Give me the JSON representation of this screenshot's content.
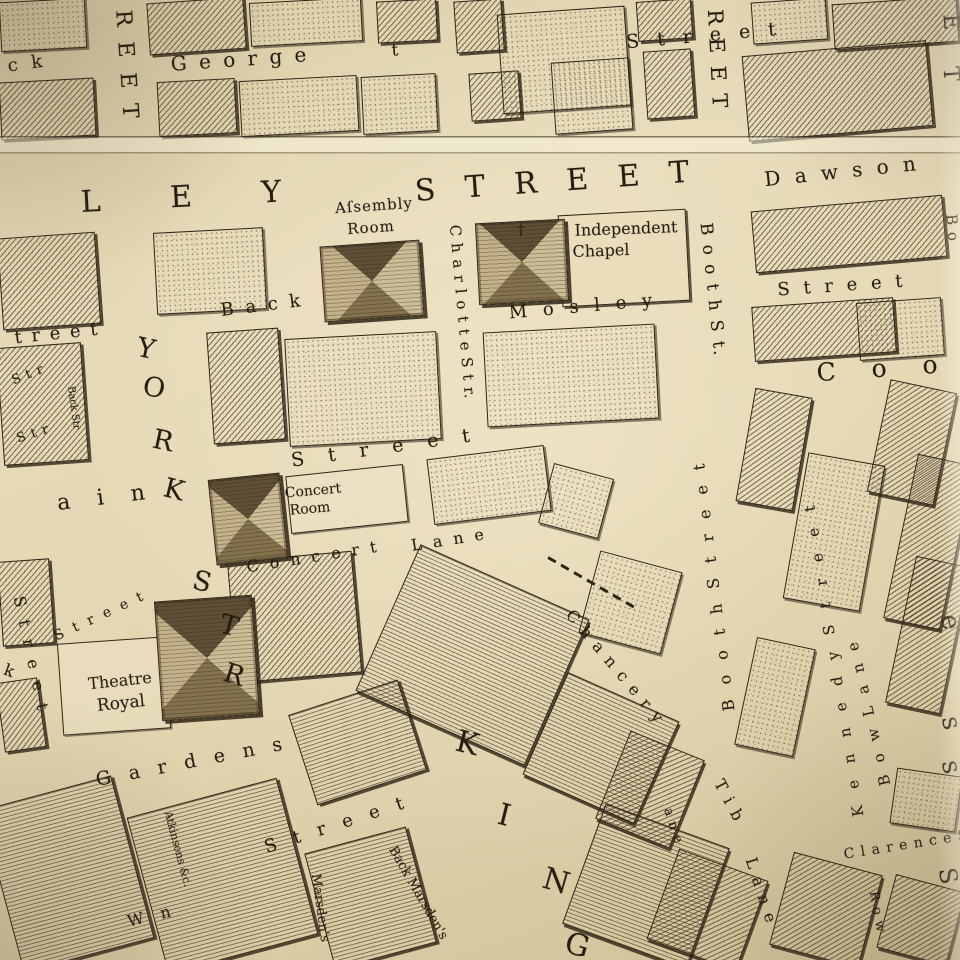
{
  "map": {
    "title": "Antique engraved town-plan (Mosley Street / King Street district)",
    "paper_color": "#e3d6b2",
    "ink_color": "#2e2415",
    "crease_y": 138,
    "labels": [
      {
        "name": "back-fragment",
        "text": "c k",
        "x": 27,
        "y": 64,
        "rot": -8,
        "size": 18,
        "ls": 4
      },
      {
        "name": "street-vertical-left",
        "text": "R E E T",
        "x": 126,
        "y": 66,
        "rot": 86,
        "size": 22,
        "ls": 4
      },
      {
        "name": "george-street",
        "text": "G e o r g e",
        "x": 240,
        "y": 59,
        "rot": -4,
        "size": 20,
        "ls": 3
      },
      {
        "name": "george-street-t",
        "text": "t",
        "x": 395,
        "y": 51,
        "rot": -4,
        "size": 17,
        "ls": 0
      },
      {
        "name": "street-top-right",
        "text": "S t r e e t",
        "x": 704,
        "y": 36,
        "rot": -5,
        "size": 19,
        "ls": 6
      },
      {
        "name": "street-vertical-top-2",
        "text": "R E E T",
        "x": 717,
        "y": 60,
        "rot": 87,
        "size": 21,
        "ls": 3
      },
      {
        "name": "mosley-ley",
        "text": "L E Y",
        "x": 196,
        "y": 197,
        "rot": -3,
        "size": 30,
        "ls": 30
      },
      {
        "name": "mosley-street-big",
        "text": "S T R E E T",
        "x": 557,
        "y": 182,
        "rot": -4,
        "size": 30,
        "ls": 10
      },
      {
        "name": "dawson-street",
        "text": "D a w s o n",
        "x": 842,
        "y": 171,
        "rot": -6,
        "size": 20,
        "ls": 4
      },
      {
        "name": "assembly-room-line1",
        "text": "Aſsembly",
        "x": 374,
        "y": 206,
        "rot": -4,
        "size": 15,
        "ls": 1
      },
      {
        "name": "assembly-room-line2",
        "text": "Room",
        "x": 371,
        "y": 228,
        "rot": -4,
        "size": 15,
        "ls": 1
      },
      {
        "name": "booth-st",
        "text": "B o o t h   S t.",
        "x": 712,
        "y": 290,
        "rot": 84,
        "size": 17,
        "ls": 2
      },
      {
        "name": "charlotte-str",
        "text": "C h a r l o t t e   S t r.",
        "x": 462,
        "y": 312,
        "rot": 85,
        "size": 15,
        "ls": 1
      },
      {
        "name": "independent-chapel-line1",
        "text": "Independent",
        "x": 626,
        "y": 229,
        "rot": -2,
        "size": 16,
        "ls": 0
      },
      {
        "name": "independent-chapel-line2",
        "text": "Chapel",
        "x": 601,
        "y": 251,
        "rot": -2,
        "size": 16,
        "ls": 0
      },
      {
        "name": "chapel-cross",
        "text": "†",
        "x": 521,
        "y": 230,
        "rot": 0,
        "size": 15,
        "ls": 0
      },
      {
        "name": "back-mosley-back",
        "text": "B a c k",
        "x": 262,
        "y": 306,
        "rot": -7,
        "size": 18,
        "ls": 3
      },
      {
        "name": "back-mosley-mosley",
        "text": "M o s l e y",
        "x": 583,
        "y": 307,
        "rot": -5,
        "size": 18,
        "ls": 5
      },
      {
        "name": "street-right-row",
        "text": "S t r e e t",
        "x": 842,
        "y": 286,
        "rot": -4,
        "size": 18,
        "ls": 4
      },
      {
        "name": "cooper-street-coo",
        "text": "C o o",
        "x": 884,
        "y": 368,
        "rot": -4,
        "size": 25,
        "ls": 14
      },
      {
        "name": "street-left-treet",
        "text": "t r e e t",
        "x": 57,
        "y": 334,
        "rot": -6,
        "size": 18,
        "ls": 2
      },
      {
        "name": "str-stub-1",
        "text": "S t r",
        "x": 28,
        "y": 375,
        "rot": -22,
        "size": 13,
        "ls": 1
      },
      {
        "name": "back-str-stub",
        "text": "Back Str",
        "x": 73,
        "y": 408,
        "rot": 82,
        "size": 10,
        "ls": 0
      },
      {
        "name": "str-stub-2",
        "text": "S t r",
        "x": 33,
        "y": 434,
        "rot": -18,
        "size": 13,
        "ls": 1
      },
      {
        "name": "york-letter-y",
        "text": "Y",
        "x": 146,
        "y": 349,
        "rot": 12,
        "size": 27,
        "ls": 0
      },
      {
        "name": "york-letter-o",
        "text": "O",
        "x": 154,
        "y": 388,
        "rot": 10,
        "size": 27,
        "ls": 0
      },
      {
        "name": "york-letter-r",
        "text": "R",
        "x": 163,
        "y": 441,
        "rot": 12,
        "size": 27,
        "ls": 0
      },
      {
        "name": "york-letter-k",
        "text": "K",
        "x": 174,
        "y": 490,
        "rot": 14,
        "size": 27,
        "ls": 0
      },
      {
        "name": "fountain-ain",
        "text": "a i n",
        "x": 106,
        "y": 498,
        "rot": -7,
        "size": 22,
        "ls": 10
      },
      {
        "name": "street-mid",
        "text": "S t r e e t",
        "x": 385,
        "y": 448,
        "rot": -8,
        "size": 19,
        "ls": 9
      },
      {
        "name": "concert-room-line1",
        "text": "Concert",
        "x": 313,
        "y": 491,
        "rot": -5,
        "size": 14,
        "ls": 0
      },
      {
        "name": "concert-room-line2",
        "text": "Room",
        "x": 310,
        "y": 509,
        "rot": -5,
        "size": 14,
        "ls": 0
      },
      {
        "name": "concert-lane-concert",
        "text": "C o n c e r t",
        "x": 313,
        "y": 557,
        "rot": -9,
        "size": 16,
        "ls": 3
      },
      {
        "name": "concert-lane-lane",
        "text": "L a n e",
        "x": 449,
        "y": 540,
        "rot": -9,
        "size": 16,
        "ls": 3
      },
      {
        "name": "chancery-lane-chancery",
        "text": "C h a n c e r y",
        "x": 615,
        "y": 667,
        "rot": 50,
        "size": 16,
        "ls": 2
      },
      {
        "name": "chancery-lane-ane",
        "text": "a n e",
        "x": 673,
        "y": 826,
        "rot": 72,
        "size": 13,
        "ls": 1
      },
      {
        "name": "booth-street-lower",
        "text": "B o o t h   S t r e e t",
        "x": 714,
        "y": 585,
        "rot": -97,
        "size": 16,
        "ls": 5
      },
      {
        "name": "kennedy-street",
        "text": "K e n n e d y   S t r e e t",
        "x": 834,
        "y": 658,
        "rot": -99,
        "size": 15,
        "ls": 6
      },
      {
        "name": "bow-lane",
        "text": "B o w   L a n e",
        "x": 869,
        "y": 712,
        "rot": -103,
        "size": 15,
        "ls": 4
      },
      {
        "name": "tib-lane-tib",
        "text": "T i b",
        "x": 729,
        "y": 801,
        "rot": 62,
        "size": 16,
        "ls": 2
      },
      {
        "name": "tib-lane-lane",
        "text": "L a n e",
        "x": 761,
        "y": 891,
        "rot": 72,
        "size": 16,
        "ls": 2
      },
      {
        "name": "clarence-street",
        "text": "C l a r e n c e   S",
        "x": 906,
        "y": 845,
        "rot": -9,
        "size": 14,
        "ls": 1
      },
      {
        "name": "row-label",
        "text": "R o w",
        "x": 877,
        "y": 912,
        "rot": 80,
        "size": 13,
        "ls": 1
      },
      {
        "name": "right-edge-letter-s3",
        "text": "S",
        "x": 948,
        "y": 876,
        "rot": 80,
        "size": 24,
        "ls": 0
      },
      {
        "name": "princess-letter-e",
        "text": "e",
        "x": 950,
        "y": 622,
        "rot": 78,
        "size": 26,
        "ls": 0
      },
      {
        "name": "princess-letter-s1",
        "text": "s",
        "x": 951,
        "y": 723,
        "rot": 78,
        "size": 26,
        "ls": 0
      },
      {
        "name": "princess-letter-s2",
        "text": "s",
        "x": 951,
        "y": 767,
        "rot": 78,
        "size": 26,
        "ls": 0
      },
      {
        "name": "right-edge-letter-e",
        "text": "E",
        "x": 950,
        "y": 22,
        "rot": 85,
        "size": 22,
        "ls": 0
      },
      {
        "name": "right-edge-letter-t",
        "text": "T",
        "x": 950,
        "y": 74,
        "rot": 85,
        "size": 22,
        "ls": 0
      },
      {
        "name": "bond-street-bo",
        "text": "B o",
        "x": 952,
        "y": 228,
        "rot": 85,
        "size": 15,
        "ls": 1
      },
      {
        "name": "king-letter-k",
        "text": "K",
        "x": 467,
        "y": 744,
        "rot": 14,
        "size": 30,
        "ls": 0
      },
      {
        "name": "king-letter-i",
        "text": "I",
        "x": 504,
        "y": 816,
        "rot": 14,
        "size": 30,
        "ls": 0
      },
      {
        "name": "king-letter-n",
        "text": "N",
        "x": 556,
        "y": 882,
        "rot": 16,
        "size": 30,
        "ls": 0
      },
      {
        "name": "king-letter-g",
        "text": "G",
        "x": 577,
        "y": 946,
        "rot": 16,
        "size": 30,
        "ls": 0
      },
      {
        "name": "street-southwest",
        "text": "S t r e e t",
        "x": 337,
        "y": 825,
        "rot": -18,
        "size": 18,
        "ls": 6
      },
      {
        "name": "w-n-fragment",
        "text": "W n",
        "x": 152,
        "y": 916,
        "rot": -14,
        "size": 16,
        "ls": 6
      },
      {
        "name": "marsdens-street",
        "text": "Marsden's",
        "x": 320,
        "y": 908,
        "rot": 82,
        "size": 13,
        "ls": 0
      },
      {
        "name": "back-marsdens",
        "text": "Back Marsden's",
        "x": 418,
        "y": 893,
        "rot": 60,
        "size": 13,
        "ls": 0
      },
      {
        "name": "atkinsons-court",
        "text": "Atkinsons &c.",
        "x": 178,
        "y": 849,
        "rot": 75,
        "size": 11,
        "ls": 0
      },
      {
        "name": "k-fragment",
        "text": "k",
        "x": 9,
        "y": 671,
        "rot": 20,
        "size": 16,
        "ls": 0
      },
      {
        "name": "street-left-vertical",
        "text": "S t r e e t",
        "x": 31,
        "y": 655,
        "rot": 78,
        "size": 16,
        "ls": 4
      },
      {
        "name": "street-nw-theatre",
        "text": "S t r e e t",
        "x": 100,
        "y": 616,
        "rot": -25,
        "size": 14,
        "ls": 3
      },
      {
        "name": "theatre-royal-line1",
        "text": "Theatre",
        "x": 120,
        "y": 681,
        "rot": -6,
        "size": 16,
        "ls": 0
      },
      {
        "name": "theatre-royal-line2",
        "text": "Royal",
        "x": 121,
        "y": 704,
        "rot": -6,
        "size": 17,
        "ls": 0
      },
      {
        "name": "spring-gardens",
        "text": "G a r d e n s",
        "x": 192,
        "y": 762,
        "rot": -11,
        "size": 19,
        "ls": 6
      },
      {
        "name": "york-street-letter-s",
        "text": "S",
        "x": 202,
        "y": 582,
        "rot": 14,
        "size": 27,
        "ls": 0
      },
      {
        "name": "york-street-letter-t",
        "text": "T",
        "x": 229,
        "y": 626,
        "rot": 16,
        "size": 27,
        "ls": 0
      },
      {
        "name": "york-street-letter-r",
        "text": "R",
        "x": 234,
        "y": 675,
        "rot": 18,
        "size": 27,
        "ls": 0
      }
    ],
    "buildings": [
      {
        "name": "assembly-room-building",
        "x": 322,
        "y": 243,
        "w": 100,
        "h": 76,
        "rot": -4
      },
      {
        "name": "independent-chapel-building",
        "x": 477,
        "y": 221,
        "w": 90,
        "h": 82,
        "rot": -3
      },
      {
        "name": "concert-room-building",
        "x": 212,
        "y": 476,
        "w": 72,
        "h": 86,
        "rot": -6
      },
      {
        "name": "theatre-royal-building",
        "x": 158,
        "y": 598,
        "w": 98,
        "h": 120,
        "rot": -4
      }
    ],
    "blocks": [
      {
        "x": 0,
        "y": 0,
        "w": 86,
        "h": 50,
        "t": "st",
        "r": -3
      },
      {
        "x": 148,
        "y": 0,
        "w": 97,
        "h": 52,
        "t": "h",
        "r": -4
      },
      {
        "x": 250,
        "y": 0,
        "w": 112,
        "h": 44,
        "t": "st",
        "r": -3
      },
      {
        "x": 377,
        "y": 0,
        "w": 60,
        "h": 42,
        "t": "h",
        "r": -3
      },
      {
        "x": 455,
        "y": 0,
        "w": 48,
        "h": 52,
        "t": "h",
        "r": -4
      },
      {
        "x": 500,
        "y": 10,
        "w": 128,
        "h": 100,
        "t": "st",
        "r": -4
      },
      {
        "x": 637,
        "y": 0,
        "w": 55,
        "h": 40,
        "t": "h",
        "r": -4
      },
      {
        "x": 752,
        "y": 0,
        "w": 75,
        "h": 42,
        "t": "st",
        "r": -4
      },
      {
        "x": 833,
        "y": 0,
        "w": 125,
        "h": 46,
        "t": "h",
        "r": -4
      },
      {
        "x": 0,
        "y": 80,
        "w": 95,
        "h": 58,
        "t": "h",
        "r": -3
      },
      {
        "x": 158,
        "y": 80,
        "w": 78,
        "h": 55,
        "t": "h",
        "r": -3
      },
      {
        "x": 240,
        "y": 78,
        "w": 118,
        "h": 56,
        "t": "st",
        "r": -3
      },
      {
        "x": 362,
        "y": 75,
        "w": 75,
        "h": 58,
        "t": "st",
        "r": -3
      },
      {
        "x": 470,
        "y": 72,
        "w": 50,
        "h": 48,
        "t": "h",
        "r": -4
      },
      {
        "x": 553,
        "y": 60,
        "w": 78,
        "h": 72,
        "t": "st",
        "r": -4
      },
      {
        "x": 645,
        "y": 50,
        "w": 48,
        "h": 68,
        "t": "h",
        "r": -4
      },
      {
        "x": 745,
        "y": 48,
        "w": 185,
        "h": 86,
        "t": "h",
        "r": -5
      },
      {
        "x": 0,
        "y": 235,
        "w": 98,
        "h": 92,
        "t": "h",
        "r": -4
      },
      {
        "x": 155,
        "y": 230,
        "w": 110,
        "h": 82,
        "t": "st",
        "r": -3
      },
      {
        "x": 753,
        "y": 203,
        "w": 192,
        "h": 62,
        "t": "h",
        "r": -5
      },
      {
        "x": 753,
        "y": 302,
        "w": 142,
        "h": 55,
        "t": "h",
        "r": -4
      },
      {
        "x": 858,
        "y": 300,
        "w": 85,
        "h": 58,
        "t": "st",
        "r": -4
      },
      {
        "x": 0,
        "y": 345,
        "w": 85,
        "h": 118,
        "t": "h",
        "r": -4
      },
      {
        "x": 210,
        "y": 330,
        "w": 72,
        "h": 112,
        "t": "h",
        "r": -4
      },
      {
        "x": 287,
        "y": 335,
        "w": 152,
        "h": 108,
        "t": "st",
        "r": -3
      },
      {
        "x": 485,
        "y": 328,
        "w": 172,
        "h": 95,
        "t": "st",
        "r": -3
      },
      {
        "x": 745,
        "y": 392,
        "w": 58,
        "h": 115,
        "t": "h",
        "r": 10
      },
      {
        "x": 878,
        "y": 385,
        "w": 68,
        "h": 115,
        "t": "h",
        "r": 12
      },
      {
        "x": 795,
        "y": 458,
        "w": 78,
        "h": 148,
        "t": "st",
        "r": 10
      },
      {
        "x": 900,
        "y": 458,
        "w": 58,
        "h": 168,
        "t": "h",
        "r": 12
      },
      {
        "x": 288,
        "y": 470,
        "w": 118,
        "h": 58,
        "t": "pl",
        "r": -6
      },
      {
        "x": 430,
        "y": 452,
        "w": 118,
        "h": 66,
        "t": "st",
        "r": -7
      },
      {
        "x": 545,
        "y": 470,
        "w": 62,
        "h": 62,
        "t": "st",
        "r": 15
      },
      {
        "x": 588,
        "y": 560,
        "w": 85,
        "h": 85,
        "t": "st",
        "r": 15
      },
      {
        "x": 0,
        "y": 560,
        "w": 52,
        "h": 85,
        "t": "h",
        "r": -4
      },
      {
        "x": 0,
        "y": 680,
        "w": 42,
        "h": 70,
        "t": "h",
        "r": -8
      },
      {
        "x": 232,
        "y": 556,
        "w": 125,
        "h": 122,
        "t": "h",
        "r": -5
      },
      {
        "x": 60,
        "y": 640,
        "w": 108,
        "h": 92,
        "t": "pl",
        "r": -4
      },
      {
        "x": 380,
        "y": 575,
        "w": 185,
        "h": 160,
        "t": "hh",
        "r": 24
      },
      {
        "x": 540,
        "y": 692,
        "w": 122,
        "h": 112,
        "t": "hh",
        "r": 24
      },
      {
        "x": 610,
        "y": 742,
        "w": 80,
        "h": 95,
        "t": "h",
        "r": 22
      },
      {
        "x": 580,
        "y": 822,
        "w": 132,
        "h": 128,
        "t": "hh",
        "r": 20
      },
      {
        "x": 0,
        "y": 790,
        "w": 135,
        "h": 168,
        "t": "hh",
        "r": -15
      },
      {
        "x": 145,
        "y": 795,
        "w": 155,
        "h": 162,
        "t": "hh",
        "r": -15
      },
      {
        "x": 318,
        "y": 838,
        "w": 105,
        "h": 120,
        "t": "hh",
        "r": -15
      },
      {
        "x": 300,
        "y": 695,
        "w": 115,
        "h": 95,
        "t": "hh",
        "r": -18
      },
      {
        "x": 660,
        "y": 862,
        "w": 95,
        "h": 96,
        "t": "h",
        "r": 20
      },
      {
        "x": 780,
        "y": 862,
        "w": 92,
        "h": 96,
        "t": "h",
        "r": 15
      },
      {
        "x": 885,
        "y": 882,
        "w": 72,
        "h": 76,
        "t": "h",
        "r": 15
      },
      {
        "x": 893,
        "y": 772,
        "w": 66,
        "h": 56,
        "t": "st",
        "r": 8
      },
      {
        "x": 745,
        "y": 642,
        "w": 60,
        "h": 110,
        "t": "st",
        "r": 12
      },
      {
        "x": 900,
        "y": 560,
        "w": 56,
        "h": 150,
        "t": "h",
        "r": 12
      },
      {
        "x": 560,
        "y": 212,
        "w": 128,
        "h": 92,
        "t": "pn",
        "r": -3
      }
    ],
    "dashes": [
      {
        "x": 548,
        "y": 556,
        "len": 100,
        "rot": 30
      }
    ]
  }
}
